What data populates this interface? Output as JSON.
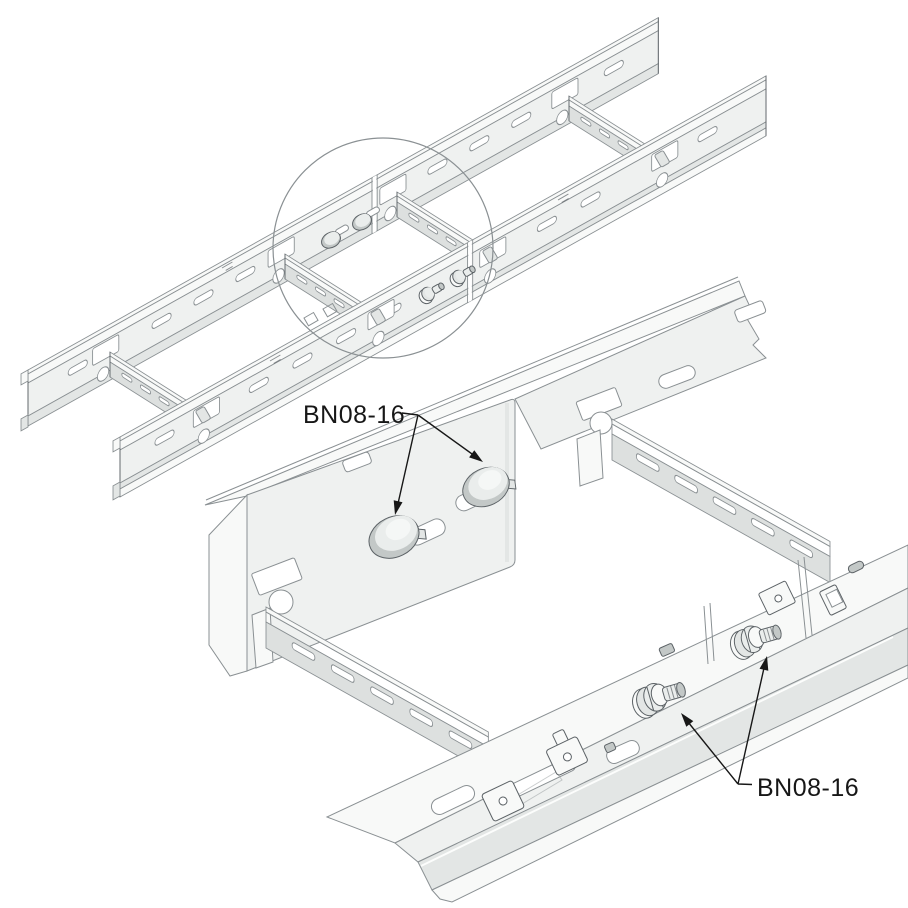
{
  "labels": {
    "detail_upper": "BN08-16",
    "detail_lower": "BN08-16"
  },
  "palette": {
    "bg": "#ffffff",
    "line": "#8a9093",
    "dark": "#5c6266",
    "panel": "#eff1f0",
    "flange": "#f8f9f8",
    "band": "#e3e6e5",
    "deep": "#cfd3d2",
    "rung": "#dde0df",
    "bolt": "#eaedec",
    "bolt_shade": "#c3c8c7",
    "ink": "#171717"
  }
}
